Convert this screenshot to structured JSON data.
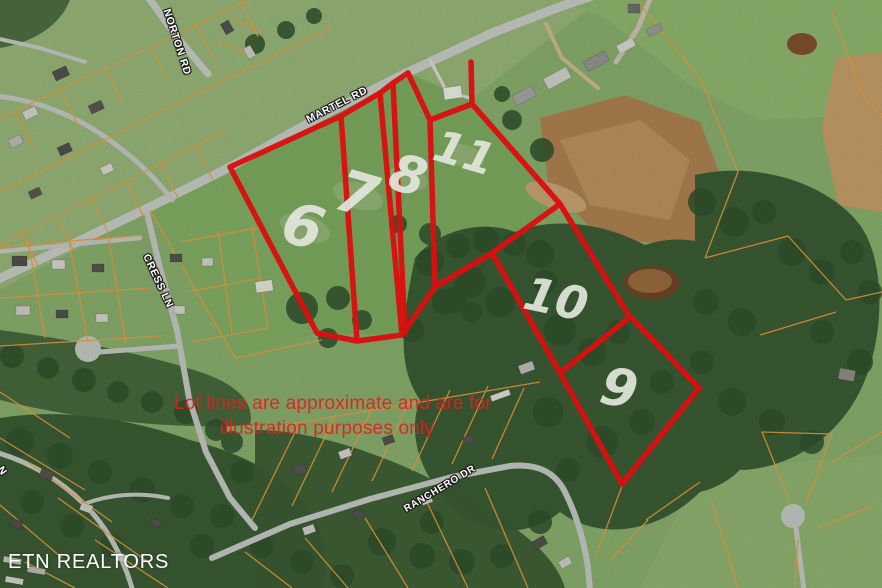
{
  "map": {
    "road_labels": {
      "norton": "NORTON RD",
      "martel": "MARTEL RD",
      "cress": "CRESS LN",
      "ranchero": "RANCHERO DR",
      "edge_partial": "N"
    },
    "lot_numbers": {
      "lot6": "6",
      "lot7": "7",
      "lot8": "8",
      "lot11": "11",
      "lot10": "10",
      "lot9": "9"
    },
    "disclaimer": {
      "line1": "Lot lines are approximate and are for",
      "line2": "illustration purposes only"
    },
    "watermark": "ETN REALTORS",
    "colors": {
      "lot_line": "#ee1111",
      "parcel_line": "#e59b3c",
      "disclaimer_text": "#e61e1e",
      "road_label_text": "#ffffff",
      "lot_number_text": "#e3e7dc"
    }
  }
}
